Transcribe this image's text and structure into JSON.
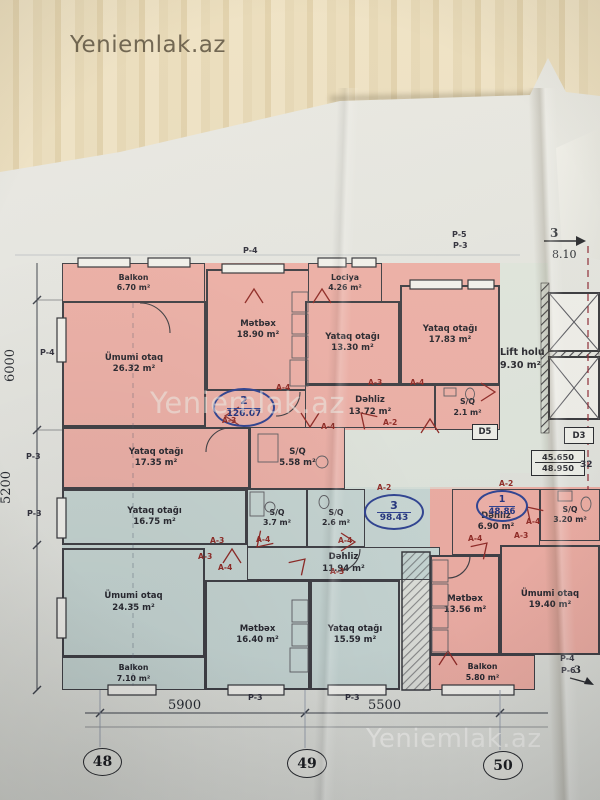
{
  "watermark": {
    "text": "Yeniemlak.az"
  },
  "apartments": {
    "apt1": {
      "number": "1",
      "total": "48.86"
    },
    "apt2": {
      "number": "2",
      "total": "126.07"
    },
    "apt3": {
      "number": "3",
      "total": "98.43"
    }
  },
  "rooms": {
    "balkon_a2": {
      "name": "Balkon",
      "area": "6.70 m²"
    },
    "umumi_a2": {
      "name": "Ümumi otaq",
      "area": "26.32 m²"
    },
    "metbex_a2": {
      "name": "Mətbəx",
      "area": "18.90 m²"
    },
    "lociya_a2": {
      "name": "Lociya",
      "area": "4.26 m²"
    },
    "yataq1_a2": {
      "name": "Yataq otağı",
      "area": "13.30 m²"
    },
    "yataq2_a2": {
      "name": "Yataq otağı",
      "area": "17.83 m²"
    },
    "dehliz_a2": {
      "name": "Dəhliz",
      "area": "13.72 m²"
    },
    "sq1_a2": {
      "name": "S/Q",
      "area": "2.1 m²"
    },
    "yataq3_a2": {
      "name": "Yataq otağı",
      "area": "17.35 m²"
    },
    "sq2_a2": {
      "name": "S/Q",
      "area": "5.58 m²"
    },
    "lift_holu": {
      "name": "Lift holu",
      "area": "9.30 m²"
    },
    "yataq1_a3": {
      "name": "Yataq otağı",
      "area": "16.75 m²"
    },
    "sq1_a3": {
      "name": "S/Q",
      "area": "3.7 m²"
    },
    "sq2_a3": {
      "name": "S/Q",
      "area": "2.6 m²"
    },
    "dehliz_a3": {
      "name": "Dəhliz",
      "area": "11.94 m²"
    },
    "umumi_a3": {
      "name": "Ümumi otaq",
      "area": "24.35 m²"
    },
    "metbex_a3": {
      "name": "Mətbəx",
      "area": "16.40 m²"
    },
    "yataq2_a3": {
      "name": "Yataq otağı",
      "area": "15.59 m²"
    },
    "balkon_a3": {
      "name": "Balkon",
      "area": "7.10 m²"
    },
    "dehliz_a1": {
      "name": "Dəhliz",
      "area": "6.90 m²"
    },
    "sq_a1": {
      "name": "S/Q",
      "area": "3.20 m²"
    },
    "metbex_a1": {
      "name": "Mətbəx",
      "area": "13.56 m²"
    },
    "umumi_a1": {
      "name": "Ümumi otaq",
      "area": "19.40 m²"
    },
    "balkon_a1": {
      "name": "Balkon",
      "area": "5.80 m²"
    }
  },
  "labels": {
    "a2": "A-2",
    "a3": "A-3",
    "a4": "A-4",
    "p3": "P-3",
    "p4": "P-4",
    "p5": "P-5",
    "p6": "P-6",
    "d3": "D3",
    "d5": "D5",
    "partial": "32"
  },
  "dimensions": {
    "bottom": [
      "5900",
      "5500"
    ],
    "left": [
      "6000",
      "5200"
    ],
    "top_right": "8.10",
    "axis_arrow": "3"
  },
  "grid_bubbles": [
    "48",
    "49",
    "50"
  ],
  "elevations": {
    "upper": "45.650",
    "lower": "48.950"
  }
}
